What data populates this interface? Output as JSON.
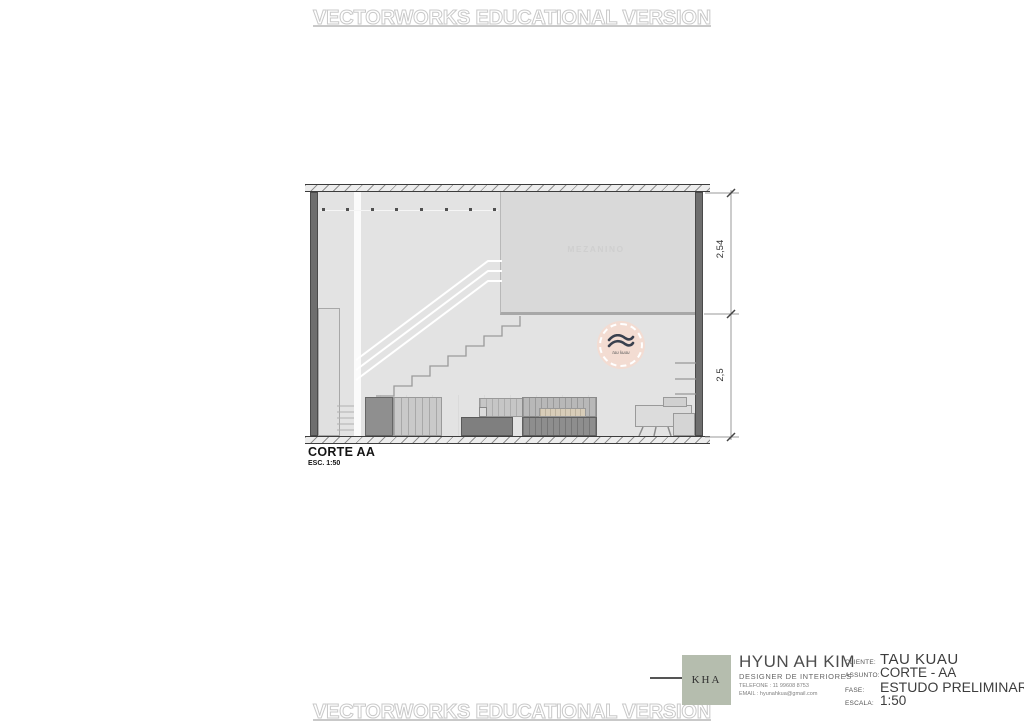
{
  "watermark": {
    "text": "VECTORWORKS EDUCATIONAL VERSION"
  },
  "drawing": {
    "title": "CORTE AA",
    "scale_note": "ESC. 1:50",
    "mezzanine_label": "MEZANINO",
    "dim_upper": "2,54",
    "dim_lower": "2,5",
    "brand_logo_text": "tau kuau"
  },
  "title_block": {
    "monogram": "KHA",
    "designer_name": "HYUN AH KIM",
    "designer_role": "DESIGNER DE INTERIORES",
    "phone": "TELEFONE : 11 99608 8753",
    "email": "EMAIL : hyunahkua@gmail.com",
    "fields": [
      {
        "label": "CLIENTE:",
        "value": "TAU KUAU"
      },
      {
        "label": "ASSUNTO:",
        "value": "CORTE - AA"
      },
      {
        "label": "FASE:",
        "value": "ESTUDO PRELIMINAR"
      },
      {
        "label": "ESCALA:",
        "value": "1:50"
      }
    ]
  },
  "colors": {
    "sage_logo": "#b5bdae",
    "blush_logo": "#f3dcd2",
    "wall_gray": "#6e6e6e",
    "interior_gray": "#e3e3e3",
    "watermark_gray": "#c9c9c9"
  }
}
